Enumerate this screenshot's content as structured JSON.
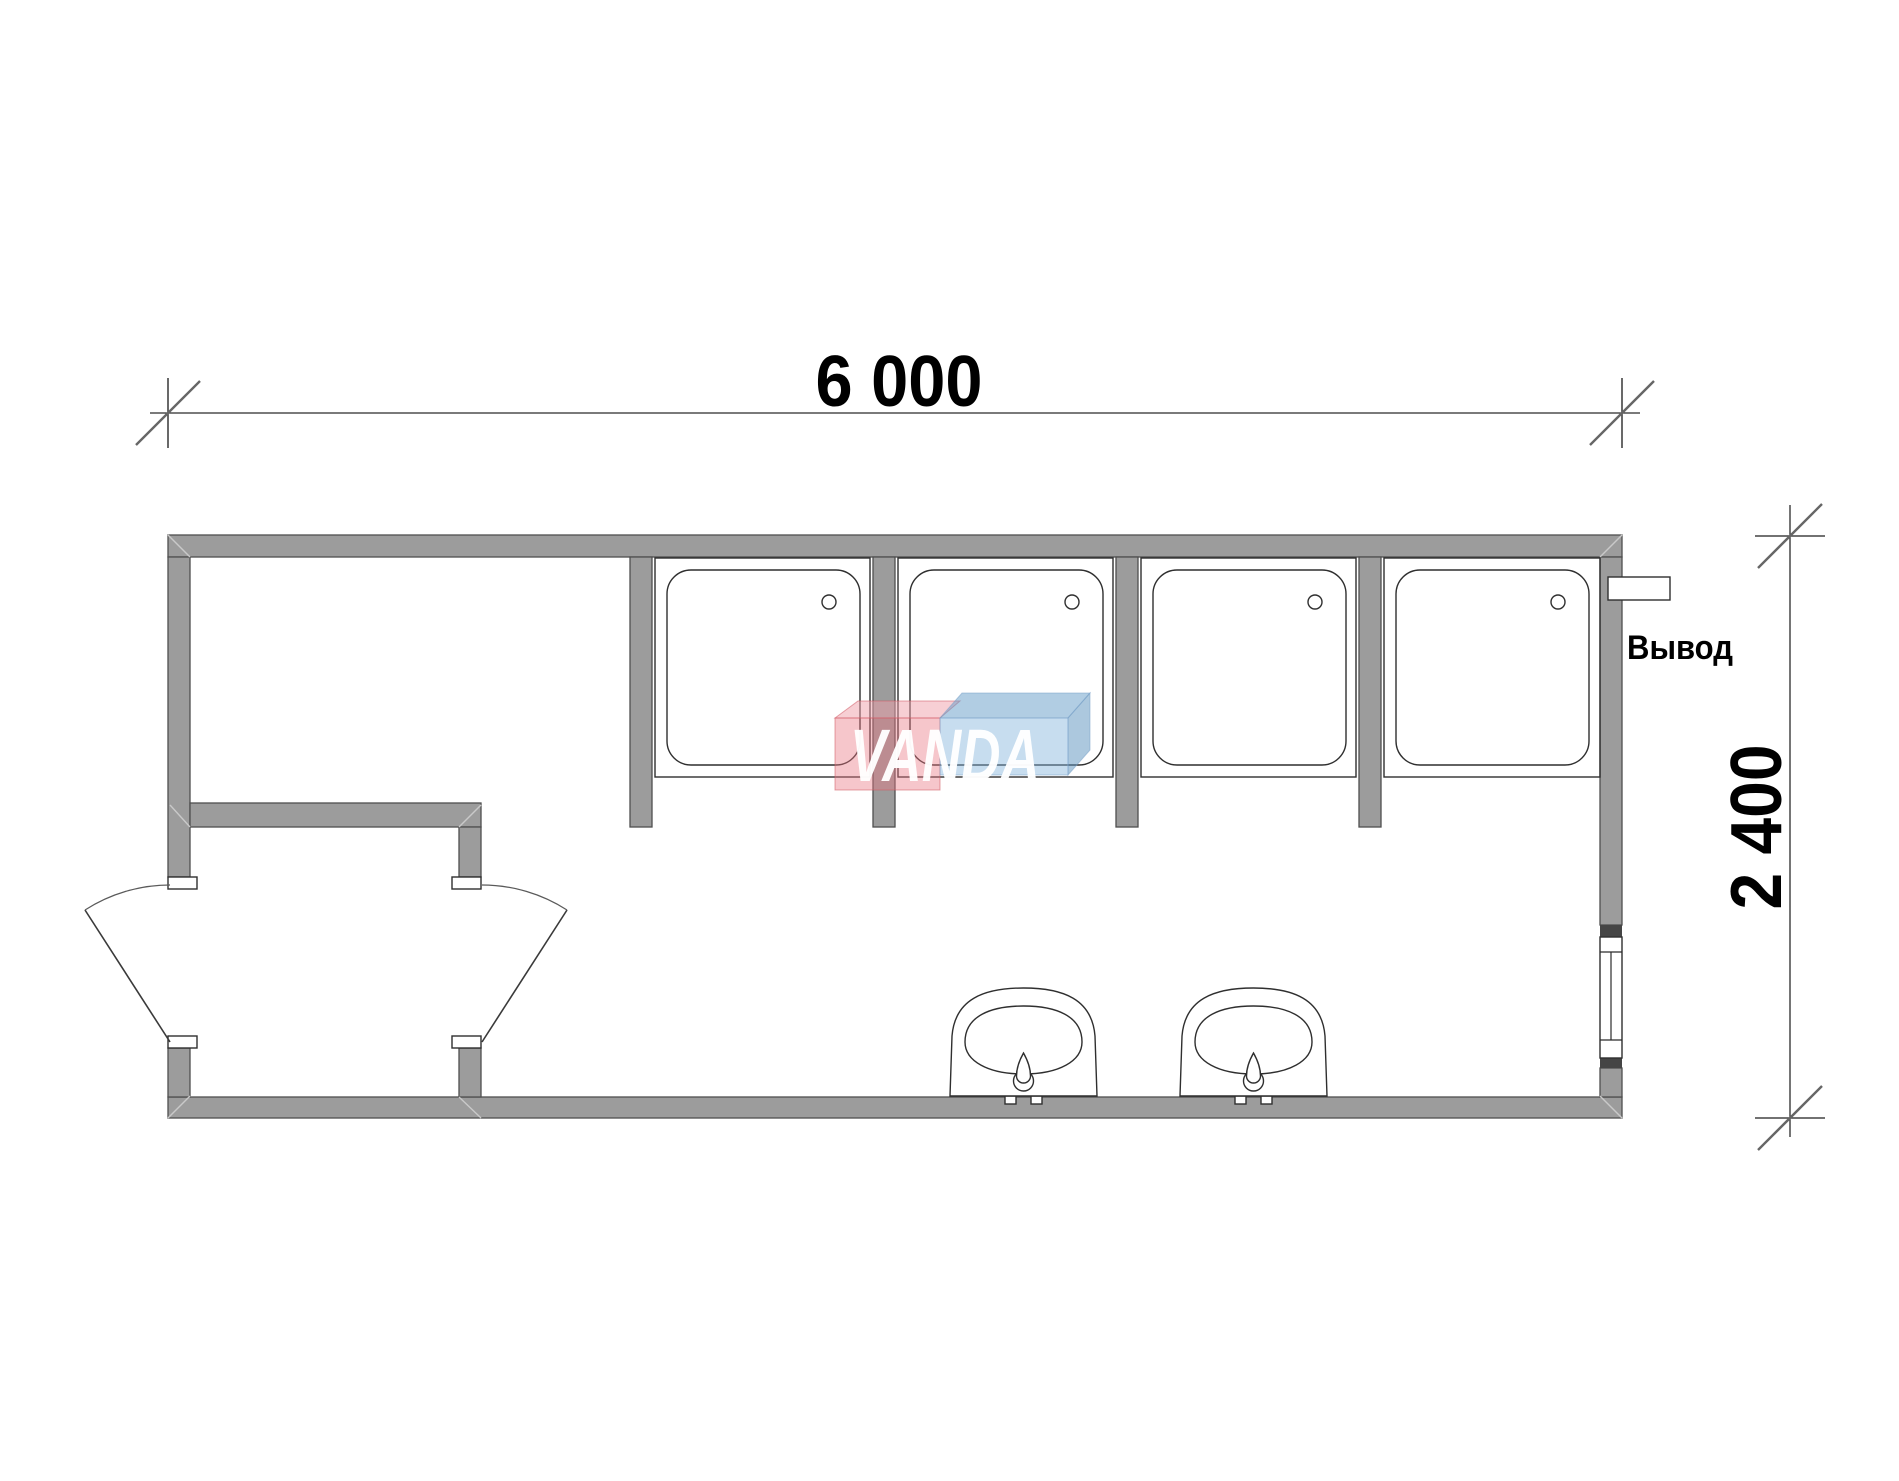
{
  "drawing": {
    "dimensions": {
      "width_label": "6 000",
      "height_label": "2 400"
    },
    "labels": {
      "outlet": "Вывод"
    },
    "watermark": {
      "text": "VANDA",
      "pink": "#e95a68",
      "blue": "#4a90c8"
    },
    "colors": {
      "wall_fill": "#9c9c9c",
      "wall_edge": "#4f4f4f",
      "line": "#2f2f2f",
      "window_jamb": "#454545",
      "dim_text": "#000000"
    },
    "fixtures": {
      "shower_trays": 4,
      "sinks": 2,
      "door_leaves": 2,
      "windows": 1,
      "outlets": 1
    }
  }
}
